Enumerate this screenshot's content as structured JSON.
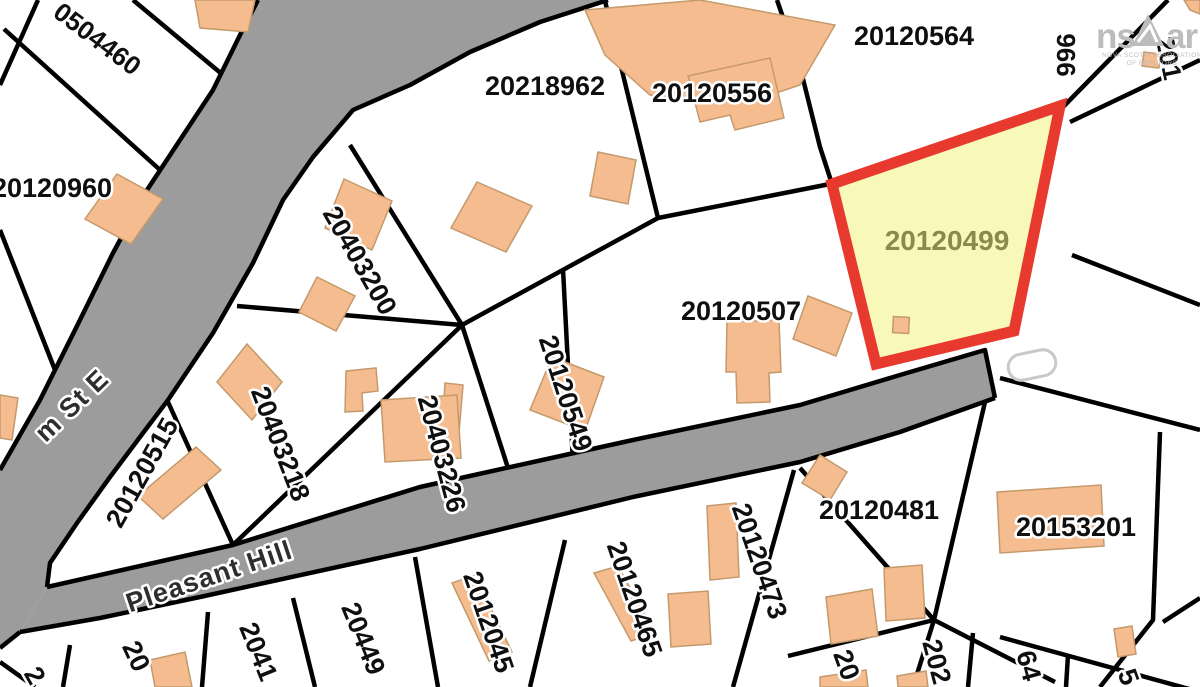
{
  "map": {
    "parcels": [
      {
        "id": "0504460"
      },
      {
        "id": "20120960"
      },
      {
        "id": "20218962"
      },
      {
        "id": "20120556"
      },
      {
        "id": "20120564"
      },
      {
        "id": "966"
      },
      {
        "id": "201"
      },
      {
        "id": "20120507"
      },
      {
        "id": "20403200"
      },
      {
        "id": "20403218"
      },
      {
        "id": "20403226"
      },
      {
        "id": "20120549"
      },
      {
        "id": "20120515"
      },
      {
        "id": "20120481"
      },
      {
        "id": "20153201"
      },
      {
        "id": "20120465"
      },
      {
        "id": "2012045"
      },
      {
        "id": "20120473"
      },
      {
        "id": "2"
      },
      {
        "id": "20"
      },
      {
        "id": "2041"
      },
      {
        "id": "20449"
      },
      {
        "id": "20"
      },
      {
        "id": "202"
      },
      {
        "id": "64"
      },
      {
        "id": "5"
      }
    ],
    "highlight": {
      "id": "20120499"
    },
    "streets": [
      {
        "name": "Pleasant Hill"
      },
      {
        "name": "m St E"
      }
    ],
    "logo": {
      "brand_left": "ns",
      "brand_right": "ar",
      "caption_line1": "NOVA SCOTIA ASSOCIATION",
      "caption_line2": "OF REALTORS"
    },
    "colors": {
      "highlight_fill": "#f8f8b8",
      "highlight_border": "#e8392f",
      "highlight_label": "#8a8a4a",
      "road_fill": "#9c9c9c",
      "building_fill": "#f5bc8f",
      "building_stroke": "#c49a6c"
    }
  }
}
